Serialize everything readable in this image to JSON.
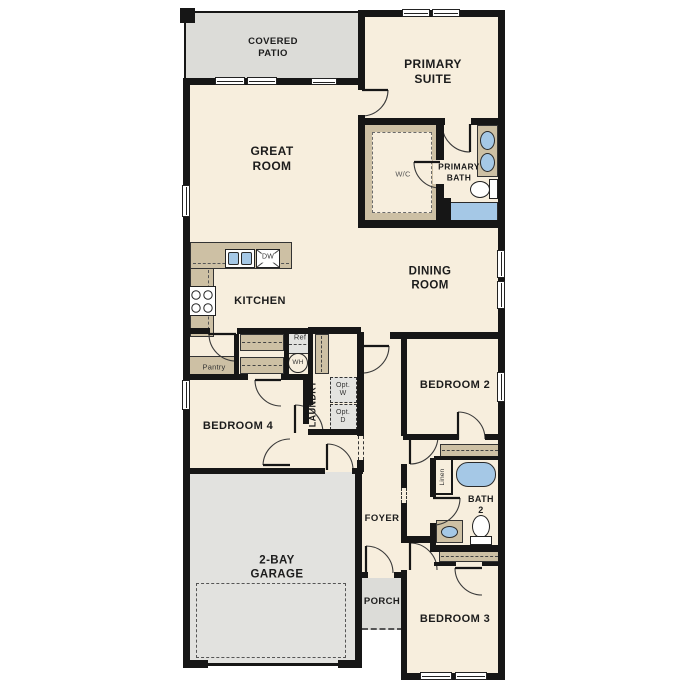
{
  "colors": {
    "floor": "#f7eedd",
    "patio_porch": "#dcdcd8",
    "garage": "#e2e2df",
    "cabinet_tan": "#cdc0a4",
    "fixture_blue": "#a5c8e6",
    "wall": "#161616"
  },
  "rooms": {
    "covered_patio": {
      "line1": "COVERED",
      "line2": "PATIO"
    },
    "primary_suite": {
      "line1": "PRIMARY",
      "line2": "SUITE"
    },
    "great_room": {
      "line1": "GREAT",
      "line2": "ROOM"
    },
    "dining_room": {
      "line1": "DINING",
      "line2": "ROOM"
    },
    "kitchen": {
      "label": "KITCHEN"
    },
    "primary_bath": {
      "line1": "PRIMARY",
      "line2": "BATH"
    },
    "walk_in_closet": {
      "label": "W/C"
    },
    "pantry": {
      "label": "Pantry"
    },
    "laundry": {
      "label": "LAUNDRY"
    },
    "foyer": {
      "label": "FOYER"
    },
    "porch": {
      "label": "PORCH"
    },
    "garage": {
      "line1": "2-BAY",
      "line2": "GARAGE"
    },
    "bedroom_2": {
      "label": "BEDROOM 2"
    },
    "bedroom_3": {
      "label": "BEDROOM 3"
    },
    "bedroom_4": {
      "label": "BEDROOM 4"
    },
    "bath_2": {
      "line1": "BATH",
      "line2": "2"
    },
    "linen": {
      "label": "Linen"
    }
  },
  "fixtures": {
    "refrigerator": {
      "label": "Ref"
    },
    "dishwasher": {
      "label": "DW"
    },
    "water_heater": {
      "label": "WH"
    },
    "optional_washer": {
      "line1": "Opt.",
      "line2": "W"
    },
    "optional_dryer": {
      "line1": "Opt.",
      "line2": "D"
    }
  }
}
